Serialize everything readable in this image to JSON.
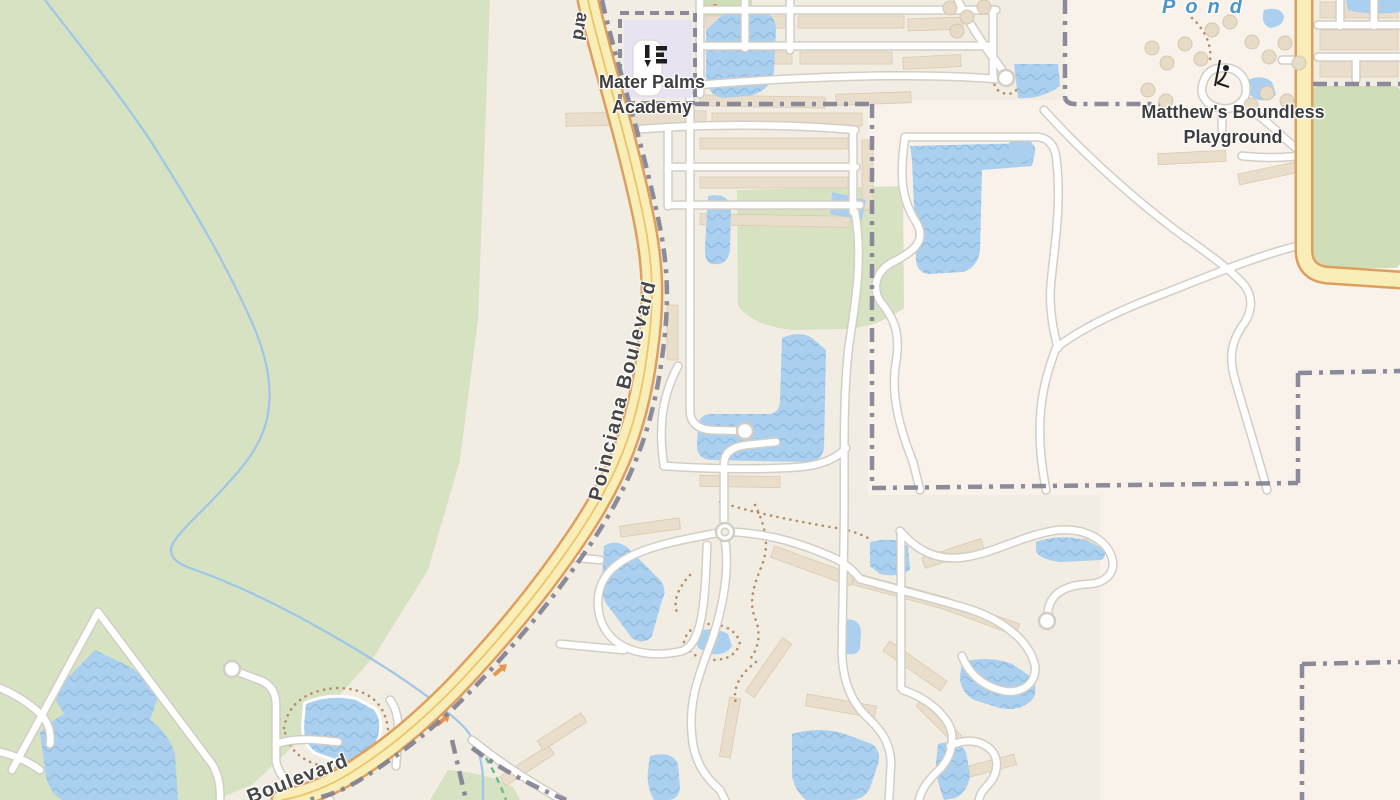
{
  "map": {
    "labels": {
      "school_line1": "Mater Palms",
      "school_line2": "Academy",
      "playground_line1": "Matthew's Boundless",
      "playground_line2": "Playground",
      "pond": "Pond",
      "main_road": "Poinciana Boulevard",
      "road_fragment_bottom": "Boulevard",
      "road_fragment_top": "ard"
    },
    "icons": {
      "school": "school-icon",
      "playground": "playground-icon"
    },
    "colors": {
      "base": "#f2ede2",
      "parcel_light": "#f8f2ea",
      "greenspace": "#d6e2c2",
      "field_green": "#cfdeb6",
      "water": "#abd0ef",
      "water_wave": "#93bee2",
      "stream": "#9ec6e8",
      "road_fill": "#ffffff",
      "road_casing": "#d2cec6",
      "primary_fill": "#f9eeb8",
      "primary_casing": "#de9f5e",
      "primary_center": "#ecc46a",
      "boundary": "#817f92",
      "building": "#e9decb",
      "building_stroke": "#dccab1",
      "footpath": "#b58c63",
      "tree": "#e6dbc6",
      "label_text": "#3e3e3e",
      "water_label_text": "#4b96c8",
      "school_parcel": "#e7e3f1",
      "cycleway": "#6cc08e",
      "oneway_arrow": "#e6954f"
    }
  }
}
